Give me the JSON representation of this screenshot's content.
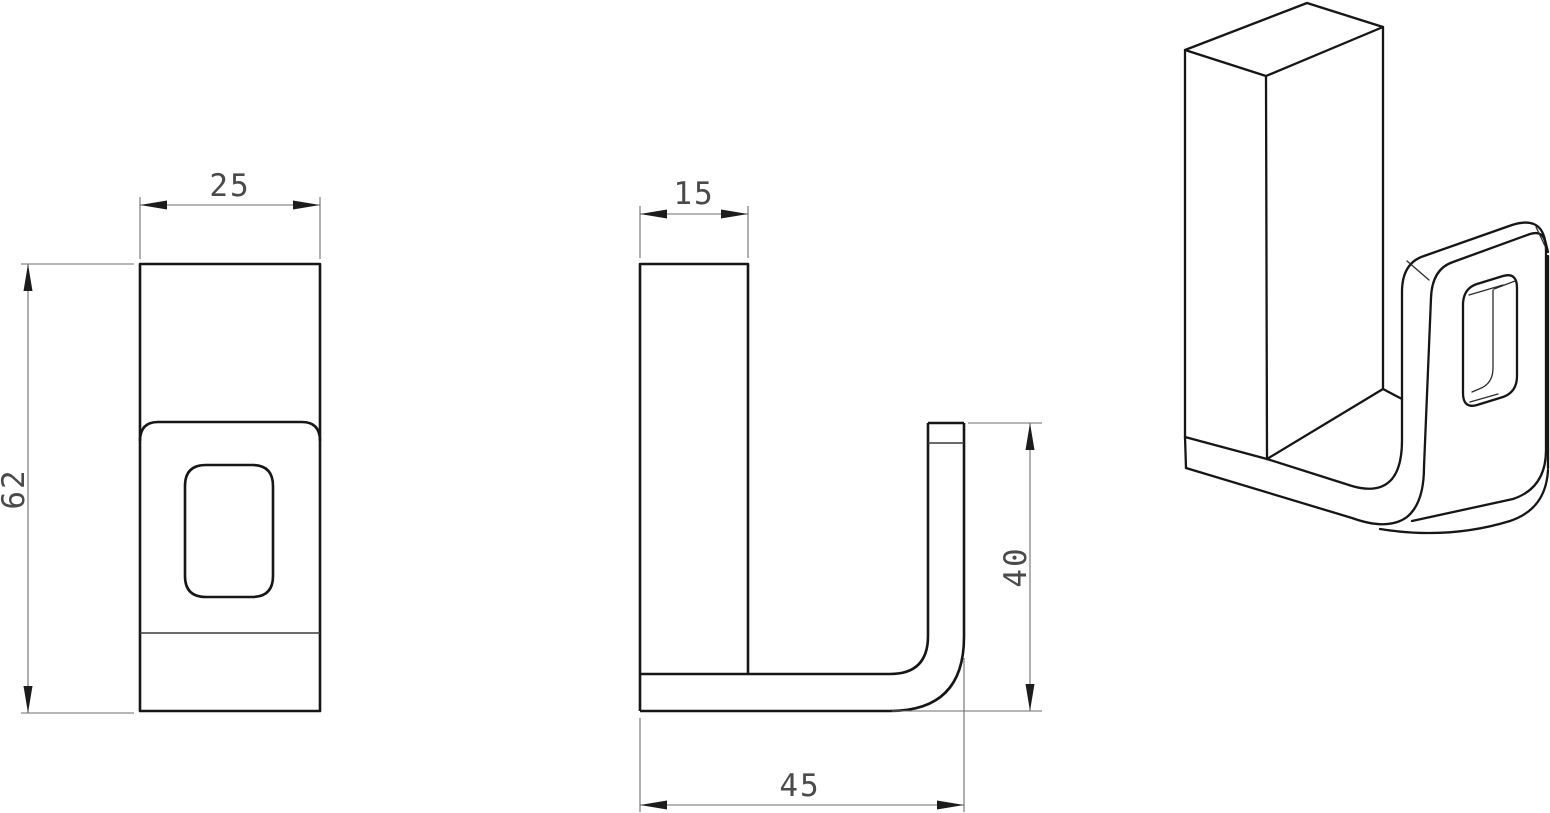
{
  "drawing": {
    "colors": {
      "background": "#ffffff",
      "object_line": "#161616",
      "thin_line": "#6e6e6e",
      "text": "#4a4a4a",
      "arrow": "#1c1c1c"
    },
    "views": {
      "front": {
        "dim_width": "25",
        "dim_height": "62"
      },
      "side": {
        "dim_thickness": "15",
        "dim_hook_height": "40",
        "dim_base_length": "45"
      },
      "isometric": {}
    }
  }
}
